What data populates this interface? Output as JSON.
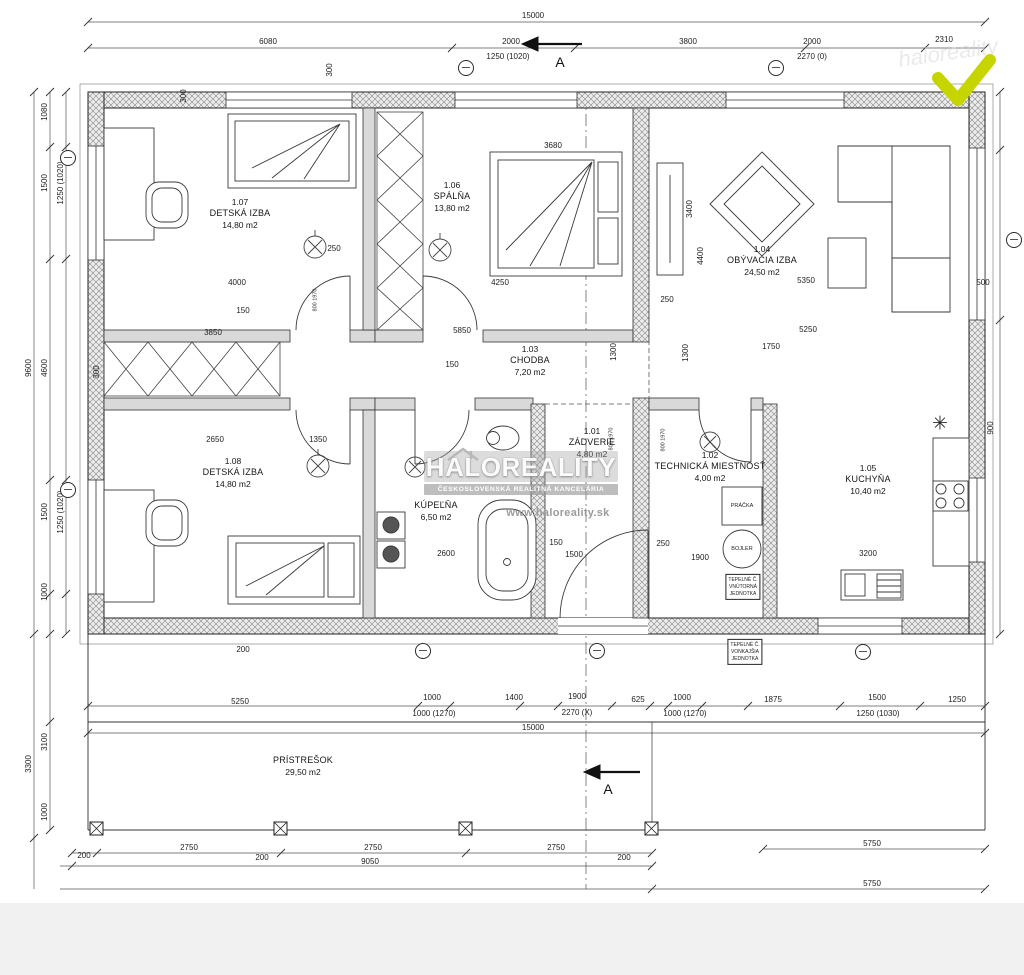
{
  "colors": {
    "background": "#ffffff",
    "bottom_band": "#f1f1f1",
    "check": "#c6d400",
    "ink": "#1c1c1c",
    "watermark_gray": "#9b9b9b"
  },
  "watermark": {
    "brand": "HALOREALITY",
    "subtitle": "ČESKOSLOVENSKÁ REALITNÁ KANCELÁRIA",
    "url": "www.haloreality.sk",
    "faint": "haloreality"
  },
  "section": {
    "label": "A"
  },
  "symbols": {
    "star": "✳"
  },
  "equipment": {
    "washer": "PRÁČKA",
    "boiler": "BOJLER",
    "boxes": [
      {
        "lines": [
          "TEPELNÉ Č.",
          "VNÚTORNÁ",
          "JEDNOTKA"
        ],
        "x": 743,
        "y": 587
      },
      {
        "lines": [
          "TEPELNÉ Č.",
          "VONKAJŠIA",
          "JEDNOTKA"
        ],
        "x": 745,
        "y": 652
      }
    ]
  },
  "rooms": [
    {
      "id": "1.07",
      "name": "DETSKÁ IZBA",
      "area": "14,80 m2",
      "x": 240,
      "y": 197
    },
    {
      "id": "1.06",
      "name": "SPÁLŇA",
      "area": "13,80 m2",
      "x": 452,
      "y": 180
    },
    {
      "id": "1.04",
      "name": "OBÝVACIA IZBA",
      "area": "24,50 m2",
      "x": 762,
      "y": 244
    },
    {
      "id": "1.03",
      "name": "CHODBA",
      "area": "7,20 m2",
      "x": 530,
      "y": 344
    },
    {
      "id": "1.08",
      "name": "DETSKÁ IZBA",
      "area": "14,80 m2",
      "x": 233,
      "y": 456
    },
    {
      "id": "1.01",
      "name": "ZÁDVERIE",
      "area": "4,80 m2",
      "x": 592,
      "y": 426
    },
    {
      "id": "1.02",
      "name": "TECHNICKÁ MIESTNOSŤ",
      "area": "4,00 m2",
      "x": 710,
      "y": 450
    },
    {
      "id": "1.05",
      "name": "KUCHYŇA",
      "area": "10,40 m2",
      "x": 868,
      "y": 463
    },
    {
      "id": "",
      "name": "KÚPEĽŇA",
      "area": "6,50 m2",
      "x": 436,
      "y": 500
    },
    {
      "id": "",
      "name": "PRÍSTREŠOK",
      "area": "29,50 m2",
      "x": 303,
      "y": 755
    }
  ],
  "axis_markers": [
    {
      "x": 466,
      "y": 68
    },
    {
      "x": 776,
      "y": 68
    },
    {
      "x": 68,
      "y": 158
    },
    {
      "x": 68,
      "y": 490
    },
    {
      "x": 1014,
      "y": 240
    },
    {
      "x": 423,
      "y": 651
    },
    {
      "x": 597,
      "y": 651
    },
    {
      "x": 863,
      "y": 652
    }
  ],
  "dimensions": [
    {
      "t": "15000",
      "x": 533,
      "y": 16
    },
    {
      "t": "6080",
      "x": 268,
      "y": 42
    },
    {
      "t": "2000",
      "x": 511,
      "y": 42
    },
    {
      "t": "1250 (1020)",
      "x": 508,
      "y": 57
    },
    {
      "t": "3800",
      "x": 688,
      "y": 42
    },
    {
      "t": "2000",
      "x": 812,
      "y": 42
    },
    {
      "t": "2270 (0)",
      "x": 812,
      "y": 57
    },
    {
      "t": "2310",
      "x": 944,
      "y": 40
    },
    {
      "t": "300",
      "x": 330,
      "y": 70,
      "r": 1
    },
    {
      "t": "300",
      "x": 184,
      "y": 96,
      "r": 1
    },
    {
      "t": "1080",
      "x": 45,
      "y": 112,
      "r": 1
    },
    {
      "t": "1500",
      "x": 45,
      "y": 183,
      "r": 1
    },
    {
      "t": "1250 (1020)",
      "x": 61,
      "y": 183,
      "r": 1
    },
    {
      "t": "9600",
      "x": 29,
      "y": 368,
      "r": 1
    },
    {
      "t": "4600",
      "x": 45,
      "y": 368,
      "r": 1
    },
    {
      "t": "300",
      "x": 97,
      "y": 372,
      "r": 1
    },
    {
      "t": "1500",
      "x": 45,
      "y": 512,
      "r": 1
    },
    {
      "t": "1250 (1020)",
      "x": 61,
      "y": 512,
      "r": 1
    },
    {
      "t": "1000",
      "x": 45,
      "y": 592,
      "r": 1
    },
    {
      "t": "200",
      "x": 243,
      "y": 650
    },
    {
      "t": "4000",
      "x": 237,
      "y": 283
    },
    {
      "t": "150",
      "x": 243,
      "y": 311
    },
    {
      "t": "3850",
      "x": 213,
      "y": 333
    },
    {
      "t": "250",
      "x": 334,
      "y": 249
    },
    {
      "t": "2650",
      "x": 215,
      "y": 440
    },
    {
      "t": "1350",
      "x": 318,
      "y": 440
    },
    {
      "t": "3680",
      "x": 553,
      "y": 146
    },
    {
      "t": "4250",
      "x": 500,
      "y": 283
    },
    {
      "t": "5850",
      "x": 462,
      "y": 331
    },
    {
      "t": "150",
      "x": 452,
      "y": 365
    },
    {
      "t": "1300",
      "x": 614,
      "y": 352,
      "r": 1
    },
    {
      "t": "1300",
      "x": 686,
      "y": 353,
      "r": 1
    },
    {
      "t": "250",
      "x": 667,
      "y": 300
    },
    {
      "t": "5350",
      "x": 806,
      "y": 281
    },
    {
      "t": "5250",
      "x": 808,
      "y": 330
    },
    {
      "t": "1750",
      "x": 771,
      "y": 347
    },
    {
      "t": "3400",
      "x": 690,
      "y": 209,
      "r": 1
    },
    {
      "t": "4400",
      "x": 701,
      "y": 256,
      "r": 1
    },
    {
      "t": "500",
      "x": 983,
      "y": 283
    },
    {
      "t": "900",
      "x": 991,
      "y": 428,
      "r": 1
    },
    {
      "t": "2600",
      "x": 446,
      "y": 554
    },
    {
      "t": "1500",
      "x": 574,
      "y": 555
    },
    {
      "t": "150",
      "x": 556,
      "y": 543
    },
    {
      "t": "250",
      "x": 663,
      "y": 544
    },
    {
      "t": "1900",
      "x": 700,
      "y": 558
    },
    {
      "t": "3200",
      "x": 868,
      "y": 554
    },
    {
      "t": "800 1970",
      "x": 316,
      "y": 300,
      "r": 1,
      "s": 1
    },
    {
      "t": "800 1970",
      "x": 612,
      "y": 439,
      "r": 1,
      "s": 1
    },
    {
      "t": "800 1970",
      "x": 664,
      "y": 440,
      "r": 1,
      "s": 1
    },
    {
      "t": "5250",
      "x": 240,
      "y": 702
    },
    {
      "t": "1000",
      "x": 432,
      "y": 698
    },
    {
      "t": "1000 (1270)",
      "x": 434,
      "y": 714
    },
    {
      "t": "1400",
      "x": 514,
      "y": 698
    },
    {
      "t": "1900",
      "x": 577,
      "y": 697
    },
    {
      "t": "2270 (X)",
      "x": 577,
      "y": 713
    },
    {
      "t": "625",
      "x": 638,
      "y": 700
    },
    {
      "t": "1000",
      "x": 682,
      "y": 698
    },
    {
      "t": "1000 (1270)",
      "x": 685,
      "y": 714
    },
    {
      "t": "1875",
      "x": 773,
      "y": 700
    },
    {
      "t": "1500",
      "x": 877,
      "y": 698
    },
    {
      "t": "1250 (1030)",
      "x": 878,
      "y": 714
    },
    {
      "t": "1250",
      "x": 957,
      "y": 700
    },
    {
      "t": "15000",
      "x": 533,
      "y": 728
    },
    {
      "t": "3100",
      "x": 45,
      "y": 742,
      "r": 1
    },
    {
      "t": "3300",
      "x": 29,
      "y": 764,
      "r": 1
    },
    {
      "t": "1000",
      "x": 45,
      "y": 812,
      "r": 1
    },
    {
      "t": "200",
      "x": 84,
      "y": 856
    },
    {
      "t": "2750",
      "x": 189,
      "y": 848
    },
    {
      "t": "200",
      "x": 262,
      "y": 858
    },
    {
      "t": "2750",
      "x": 373,
      "y": 848
    },
    {
      "t": "9050",
      "x": 370,
      "y": 862
    },
    {
      "t": "2750",
      "x": 556,
      "y": 848
    },
    {
      "t": "200",
      "x": 624,
      "y": 858
    },
    {
      "t": "5750",
      "x": 872,
      "y": 844
    },
    {
      "t": "5750",
      "x": 872,
      "y": 884
    }
  ]
}
